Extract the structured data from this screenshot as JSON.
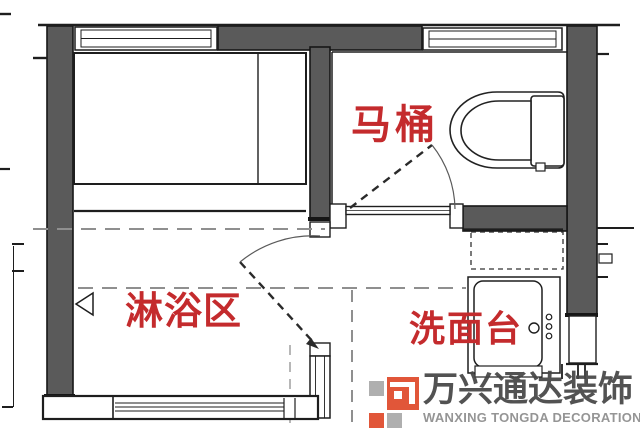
{
  "plan": {
    "type": "bathroom-floor-plan",
    "labels": {
      "toilet": "马桶",
      "shower_area": "淋浴区",
      "wash_basin": "洗面台"
    },
    "colors": {
      "label_red": "#c42b2d",
      "wall_gray": "#5a5a5a",
      "line_black": "#1e1e1e",
      "dash_gray": "#8f8f8f"
    },
    "fixtures": [
      "toilet",
      "vanity-sink",
      "mirror-cabinet",
      "shower-drain",
      "windows",
      "swing-doors"
    ]
  },
  "watermark": {
    "brand_cn": "万兴通达装饰",
    "brand_en": "WANXING TONGDA DECORATION",
    "colors": {
      "logo_red": "#df4a2b",
      "logo_gray": "#a9a9a9",
      "text_cn": "#454545",
      "text_en": "#8d8d8d"
    }
  }
}
